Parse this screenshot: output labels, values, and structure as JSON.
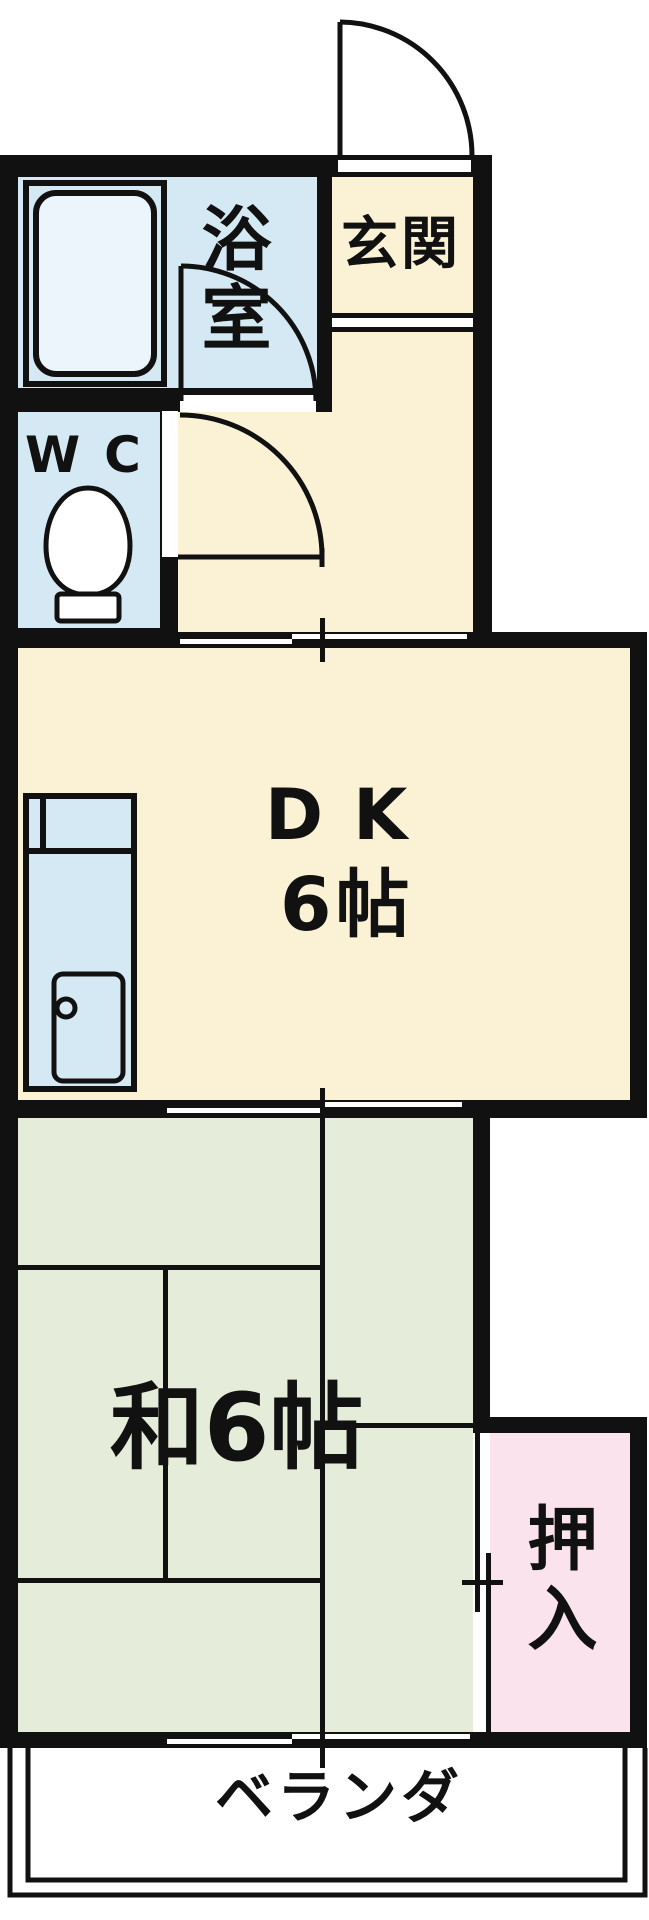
{
  "meta": {
    "kind": "japanese-apartment-floor-plan"
  },
  "colors": {
    "wall": "#111111",
    "cream": "#fbf2d6",
    "blue": "#d5e9f4",
    "tub": "#ebf5fb",
    "green": "#e6ecda",
    "pink": "#fbe3ee",
    "white": "#ffffff"
  },
  "rooms": {
    "genkan": {
      "label": "玄関"
    },
    "bathroom": {
      "label": "浴室"
    },
    "wc": {
      "label": "WC"
    },
    "dk": {
      "label": "DK",
      "size": "6帖"
    },
    "washitsu": {
      "label": "和6帖"
    },
    "oshiire": {
      "label": "押入"
    },
    "veranda": {
      "label": "ベランダ"
    }
  },
  "fixtures": {
    "bathtub": "bathtub",
    "toilet": "toilet",
    "kitchen_counter": "kitchen-sink-counter",
    "stove": "stove",
    "entrance_door": "hinged-door",
    "bathroom_door": "hinged-door",
    "wc_door": "hinged-door",
    "sliding_doors": "double-sliding-doors"
  }
}
